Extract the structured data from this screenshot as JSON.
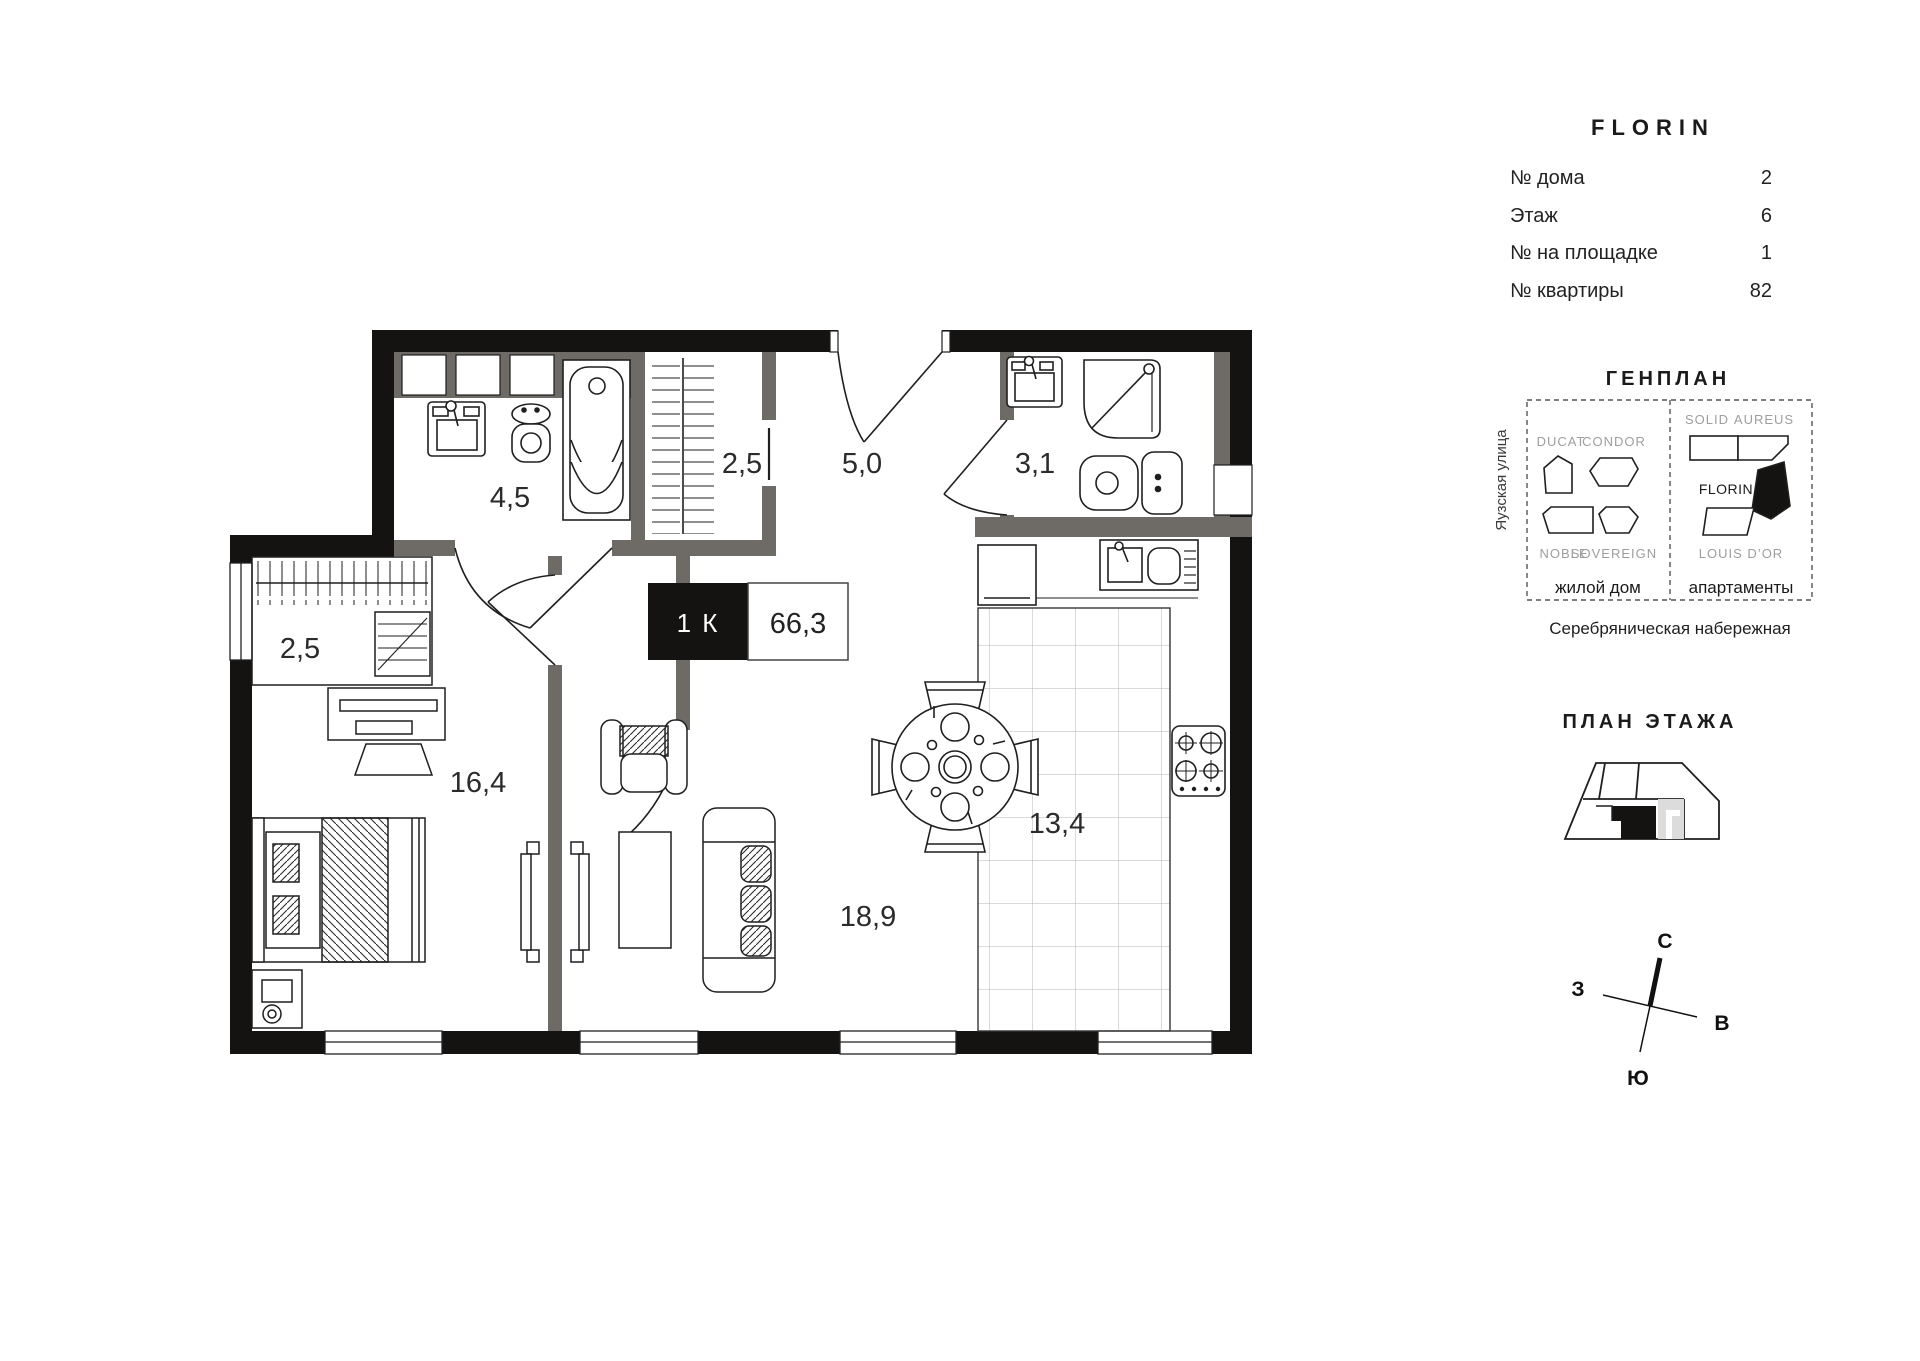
{
  "project": {
    "name": "FLORIN"
  },
  "info": {
    "rows": [
      {
        "label": "№ дома",
        "value": "2"
      },
      {
        "label": "Этаж",
        "value": "6"
      },
      {
        "label": "№ на площадке",
        "value": "1"
      },
      {
        "label": "№ квартиры",
        "value": "82"
      }
    ]
  },
  "unit": {
    "type": "1 К",
    "area": "66,3"
  },
  "plan": {
    "labels": {
      "bathroom": "4,5",
      "closet_top": "2,5",
      "hallway": "5,0",
      "shower_room": "3,1",
      "closet_left": "2,5",
      "bedroom": "16,4",
      "living": "18,9",
      "kitchen": "13,4"
    }
  },
  "genplan": {
    "title": "ГЕНПЛАН",
    "street_left": "Яузская улица",
    "embankment": "Серебряническая набережная",
    "buildings": {
      "ducat": "DUCAT",
      "condor": "CONDOR",
      "noble": "NOBLE",
      "sovereign": "SOVEREIGN",
      "solid": "SOLID",
      "aureus": "AUREUS",
      "florin": "FLORIN",
      "louis": "LOUIS D’OR"
    },
    "captions": {
      "residential": "жилой дом",
      "apartments": "апартаменты"
    }
  },
  "floor_plan": {
    "title": "ПЛАН ЭТАЖА"
  },
  "compass": {
    "n": "С",
    "s": "Ю",
    "w": "З",
    "e": "В"
  },
  "colors": {
    "exterior_wall": "#151312",
    "interior_wall": "#6E6A65",
    "line": "#1F1F1F",
    "tile_grid": "#B8B5B0",
    "muted_text": "#9E9E9E"
  }
}
